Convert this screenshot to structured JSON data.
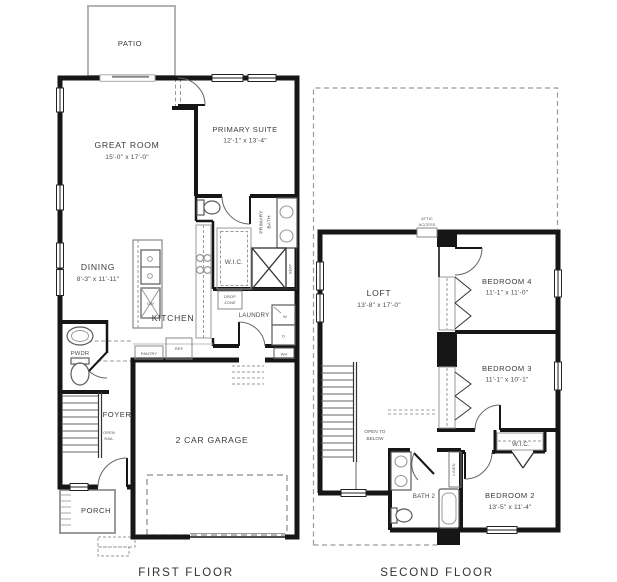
{
  "titles": {
    "first_floor": "FIRST FLOOR",
    "second_floor": "SECOND FLOOR"
  },
  "ff": {
    "patio": "PATIO",
    "great_room": {
      "name": "GREAT ROOM",
      "dims": "15'-0\" x 17'-0\""
    },
    "primary_suite": {
      "name": "PRIMARY SUITE",
      "dims": "12'-1\" x 13'-4\""
    },
    "primary_bath": {
      "l1": "PRIMARY",
      "l2": "BATH"
    },
    "wic": "W.I.C.",
    "seat": "SEAT",
    "dining": {
      "name": "DINING",
      "dims": "8'-3\" x 11'-11\""
    },
    "kitchen": "KITCHEN",
    "dw": "DW",
    "drop_zone": {
      "l1": "DROP",
      "l2": "ZONE"
    },
    "laundry": "LAUNDRY",
    "washer": "W",
    "dryer": "D",
    "wh": "WH",
    "pantry": "PANTRY",
    "ref": "REF",
    "pwdr": "PWDR",
    "foyer": "FOYER",
    "open_rail": {
      "l1": "OPEN",
      "l2": "RAIL"
    },
    "garage": "2 CAR GARAGE",
    "porch": "PORCH"
  },
  "sf": {
    "attic": {
      "l1": "ATTIC",
      "l2": "ACCESS"
    },
    "loft": {
      "name": "LOFT",
      "dims": "13'-8\" x 17'-0\""
    },
    "bedroom4": {
      "name": "BEDROOM 4",
      "dims": "11'-1\" x 11'-0\""
    },
    "bedroom3": {
      "name": "BEDROOM 3",
      "dims": "11'-1\" x 10'-1\""
    },
    "bedroom2": {
      "name": "BEDROOM 2",
      "dims": "13'-5\" x 11'-4\""
    },
    "wic": "W.I.C.",
    "bath2": "BATH 2",
    "linen": "LINEN",
    "open_below": {
      "l1": "OPEN TO",
      "l2": "BELOW"
    }
  },
  "colors": {
    "wall": "#161616",
    "fixture_line": "#5a5a5a",
    "dashed_line": "#999999",
    "patio_outline": "#b3b3b3",
    "text": "#3c3c3c",
    "background": "#ffffff"
  }
}
